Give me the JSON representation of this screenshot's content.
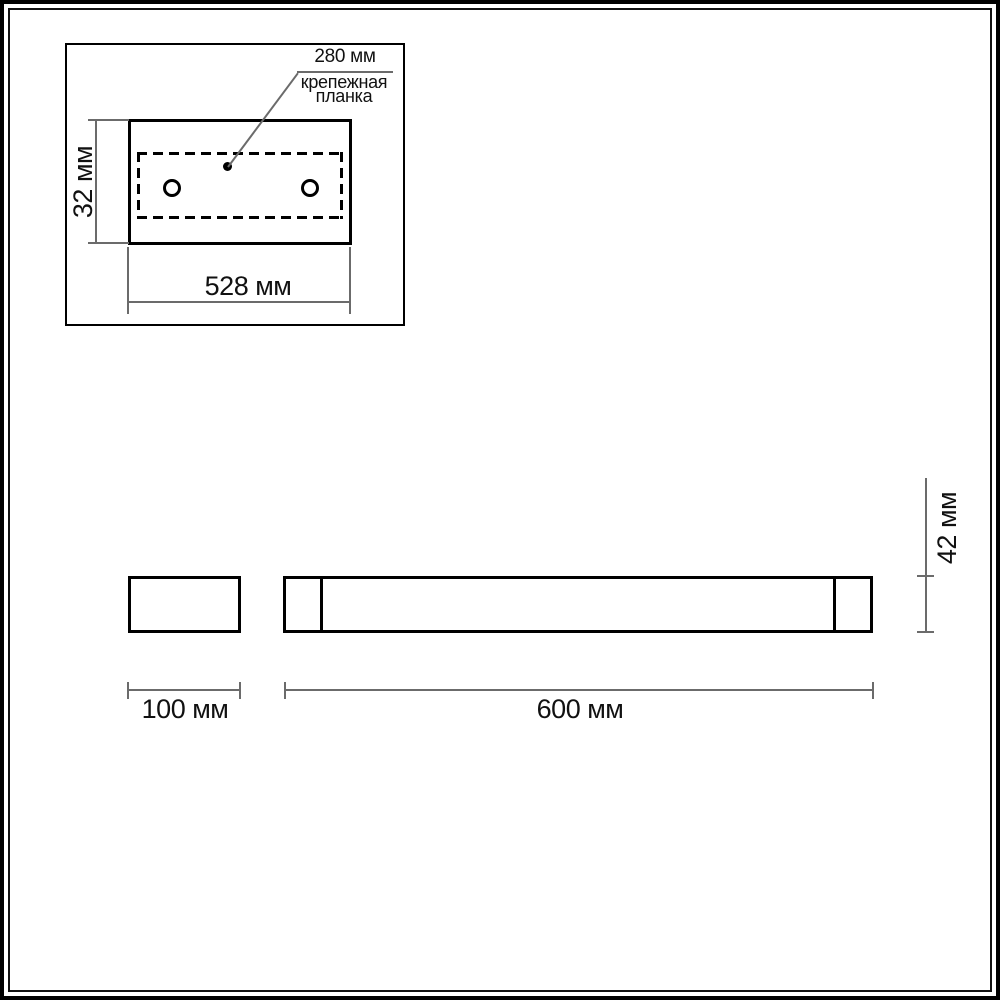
{
  "colors": {
    "background": "#ffffff",
    "outline": "#000000",
    "dimension_line": "#6b6b6b",
    "text": "#111111"
  },
  "top_view": {
    "plate_width_label": "280 мм",
    "plate_name_line1": "крепежная",
    "plate_name_line2": "планка",
    "height_label": "32 мм",
    "width_label": "528 мм"
  },
  "front_view": {
    "length_label": "600 мм",
    "height_label": "42 мм"
  },
  "side_view": {
    "width_label": "100 мм"
  }
}
